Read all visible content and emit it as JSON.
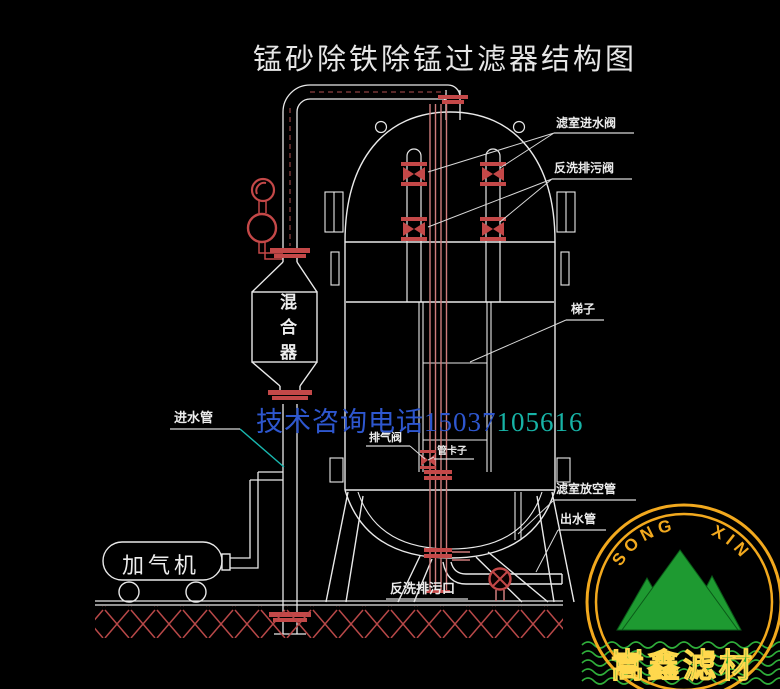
{
  "title": "锰砂除铁除锰过滤器结构图",
  "watermark": {
    "part1": "技术咨询电话15037",
    "part2": "105616"
  },
  "vessel_labels": {
    "filter_inlet_valve": "滤室进水阀",
    "backwash_drain_valve": "反洗排污阀",
    "ladder": "梯子",
    "chamber_vent_pipe": "滤室放空管",
    "outlet_pipe": "出水管",
    "inlet_pipe": "进水管",
    "exhaust_valve": "排气阀",
    "pipe_clamp": "管卡子",
    "backwash_drain_outlet": "反洗排污口"
  },
  "equipment": {
    "mixer": "混合器",
    "aerator": "加气机"
  },
  "logo": {
    "arc_text": "SONG XIN",
    "company_name": "嵩鑫滤材"
  },
  "colors": {
    "background": "#000000",
    "line_white": "#e9e9e9",
    "pipe_red": "#cf7d7d",
    "valve_red": "#c44848",
    "watermark_blue": "#2e57cf",
    "watermark_teal": "#17b3a6",
    "leader_teal": "#19b8b0",
    "logo_yellow": "#f2a91e",
    "logo_green": "#1e9a31"
  }
}
